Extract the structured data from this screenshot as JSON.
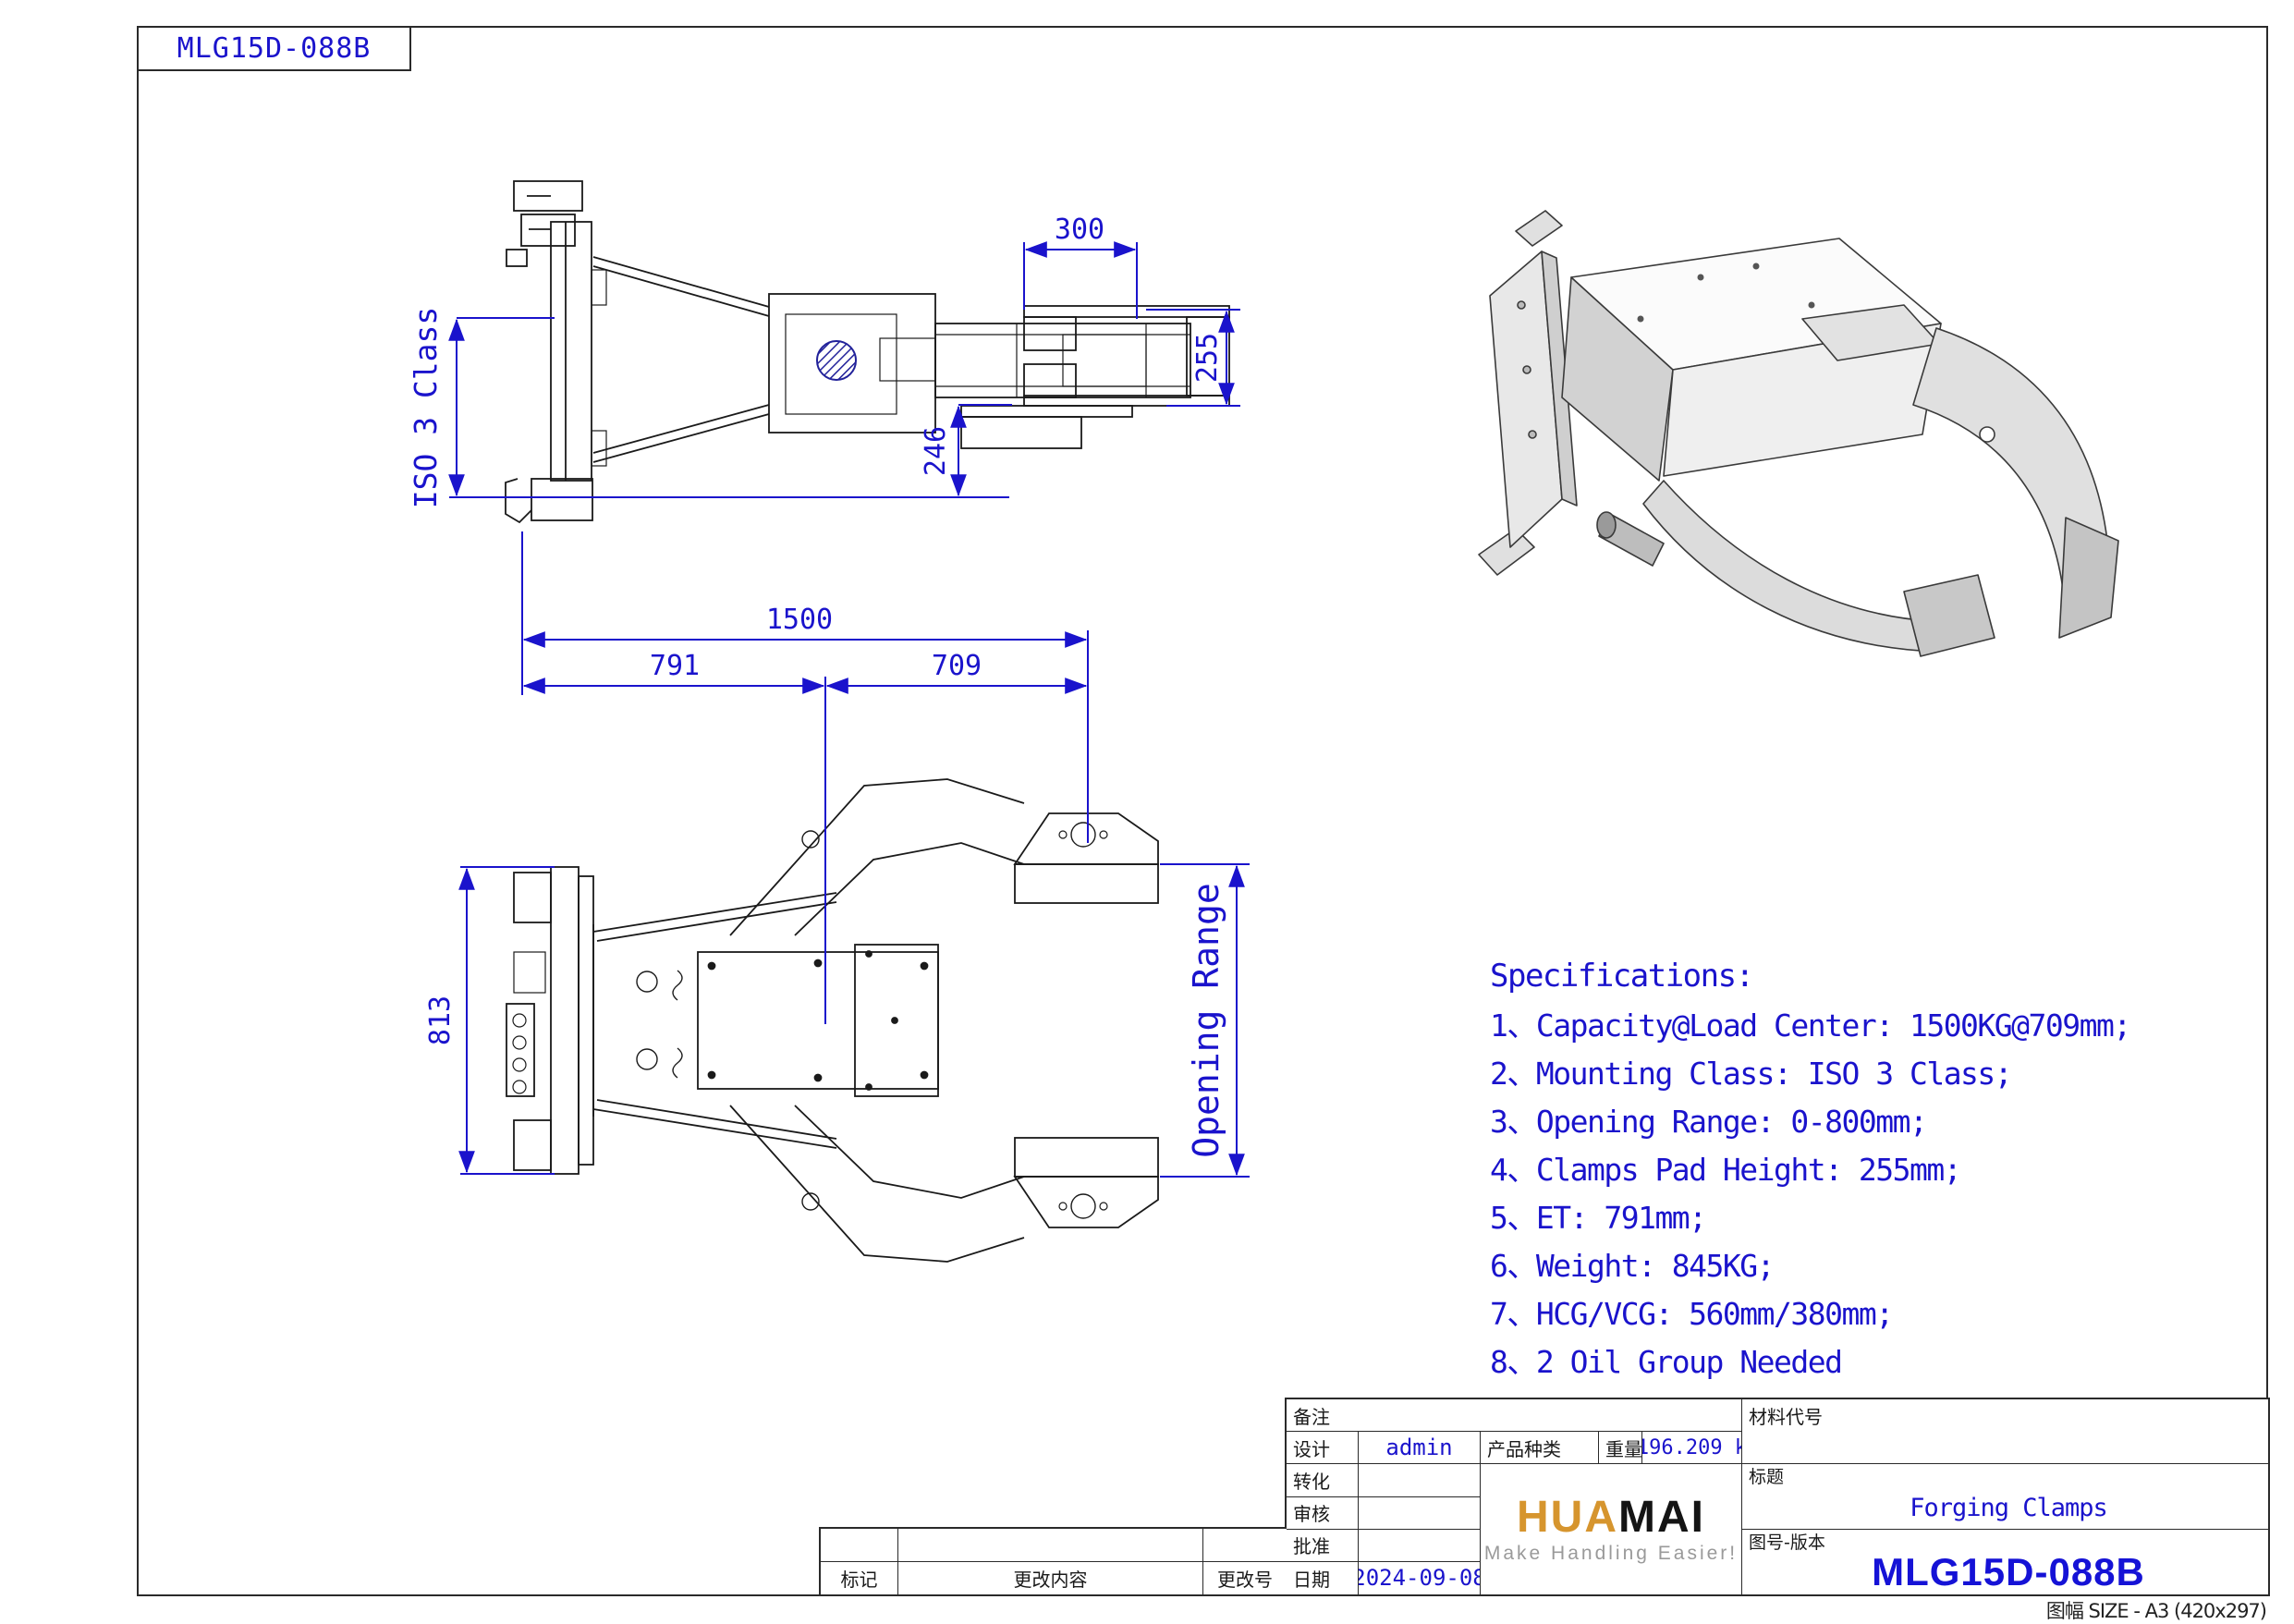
{
  "header": {
    "doc_code": "MLG15D-088B"
  },
  "drawing": {
    "side_view": {
      "dims": {
        "pad_width": "300",
        "pad_height": "255",
        "offset": "246",
        "mount_class": "ISO 3 Class"
      }
    },
    "plan_view": {
      "dims": {
        "overall_length": "1500",
        "et": "791",
        "load_center": "709",
        "plate_height": "813",
        "opening_range": "Opening Range"
      }
    }
  },
  "specs": {
    "title": "Specifications:",
    "items": [
      "1、Capacity@Load Center: 1500KG@709mm;",
      "2、Mounting Class: ISO 3 Class;",
      "3、Opening Range: 0-800mm;",
      "4、Clamps Pad Height: 255mm;",
      "5、ET: 791mm;",
      "6、Weight: 845KG;",
      "7、HCG/VCG: 560mm/380mm;",
      "8、2 Oil Group Needed"
    ]
  },
  "title_block": {
    "remark_label": "备注",
    "design_label": "设计",
    "design_value": "admin",
    "convert_label": "转化",
    "review_label": "审核",
    "approve_label": "批准",
    "date_label": "日期",
    "date_value": "2024-09-08",
    "product_type_label": "产品种类",
    "weight_label": "重量",
    "weight_value": "1196.209 kg",
    "material_code_label": "材料代号",
    "title_label": "标题",
    "title_value": "Forging Clamps",
    "drawing_no_label": "图号-版本",
    "drawing_no_value": "MLG15D-088B",
    "mark_label": "标记",
    "change_content_label": "更改内容",
    "change_no_label": "更改号",
    "sheet_size": "图幅 SIZE - A3 (420x297)"
  },
  "logo": {
    "brand_left": "HUA",
    "brand_right": "MAI",
    "tagline": "Make Handling Easier!"
  },
  "colors": {
    "dimension_blue": "#1a13cc",
    "line_black": "#1a1a1a",
    "logo_orange": "#d6952e",
    "logo_black": "#141414",
    "tagline_gray": "#9a9a9a"
  }
}
